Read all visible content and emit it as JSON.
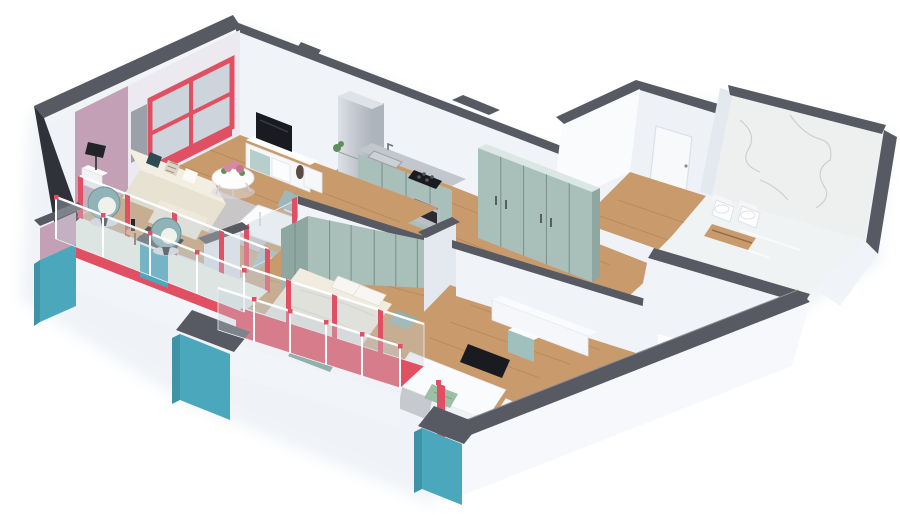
{
  "meta": {
    "title": "3D isometric dollhouse render of an apartment floor plan",
    "view": "cutaway axonometric, white background, no visible text"
  },
  "palette": {
    "background": "#ffffff",
    "wall_cap": "#585a63",
    "wall_cap_dark": "#42444c",
    "wall_white": "#f0f3f8",
    "wall_side": "#e4e8ef",
    "wall_bright": "#fafbfd",
    "wall_dark_edge": "#303239",
    "accent_mauve": "#c3a0b5",
    "accent_teal": "#4aa7bc",
    "accent_teal_dark": "#3e93a7",
    "accent_red": "#e05062",
    "accent_red_dark": "#c9455a",
    "floor_wood": "#c99b6c",
    "floor_wood_light": "#d6ac7e",
    "floor_mint": "#ebf1ea",
    "cabinet_sage": "#a9bfba",
    "cabinet_sage_dark": "#8ea7a1",
    "countertop": "#c2c7cd",
    "steel": "#c7ccd2",
    "marble": "#edf0ef",
    "marble_vein": "#aeb2ad",
    "glass": "#c3ced8",
    "fabric_cream": "#efe9db",
    "fabric_cream_dark": "#e8e2d3",
    "pillow_teal": "#2e4b55",
    "tv_black": "#1a1b20",
    "plant_green": "#5f8f5a",
    "flower_pink": "#d58aa4",
    "rug_gray": "#c8cbd0",
    "shadow": "#e3e9f0"
  },
  "scene": {
    "rooms": [
      {
        "name": "living-room",
        "floor": "wood",
        "furniture": [
          "corner-sofa",
          "throw-pillows",
          "floor-lamp",
          "side-table",
          "round-coffee-table",
          "flower-centerpiece",
          "area-rug",
          "tv",
          "tv-cabinet",
          "decor-vase",
          "red-framed-window",
          "wall-art",
          "mauve-accent-wall"
        ]
      },
      {
        "name": "dining-area",
        "floor": "wood",
        "furniture": [
          "white-dining-table",
          "potted-plant",
          "teal-chairs"
        ]
      },
      {
        "name": "kitchen",
        "floor": "wood",
        "furniture": [
          "fridge",
          "sage-cabinets",
          "sink",
          "cooktop",
          "oven",
          "small-plant"
        ]
      },
      {
        "name": "hallway",
        "floor": "wood",
        "furniture": [
          "five-door-sage-wardrobe"
        ]
      },
      {
        "name": "entry",
        "floor": "wood",
        "furniture": [
          "front-door"
        ]
      },
      {
        "name": "bathroom",
        "floor": "marble",
        "furniture": [
          "marble-walls",
          "wall-hung-toilet",
          "bidet",
          "wooden-bench"
        ]
      },
      {
        "name": "master-bedroom",
        "floor": "wood",
        "furniture": [
          "double-bed",
          "pillows",
          "sage-benches",
          "fitted-wardrobe-run",
          "corner-wardrobe",
          "glazed-balcony-door"
        ]
      },
      {
        "name": "kids-bedroom",
        "floor": "wood",
        "furniture": [
          "single-bed",
          "black-headboard-panel",
          "green-pillow",
          "desk-counter",
          "teal-cabinet",
          "glazed-balcony-door"
        ]
      },
      {
        "name": "balcony",
        "floor": "red-with-mint-walkway",
        "furniture": [
          "egg-chair",
          "egg-chair",
          "wooden-side-table",
          "bottle",
          "glass-railing",
          "teal-parapet-pillars"
        ]
      }
    ],
    "exterior": [
      "dark-gray-wall-caps",
      "white-walls",
      "teal-lower-band",
      "red-floor-slabs",
      "glass-balustrade-with-red-connectors"
    ]
  }
}
